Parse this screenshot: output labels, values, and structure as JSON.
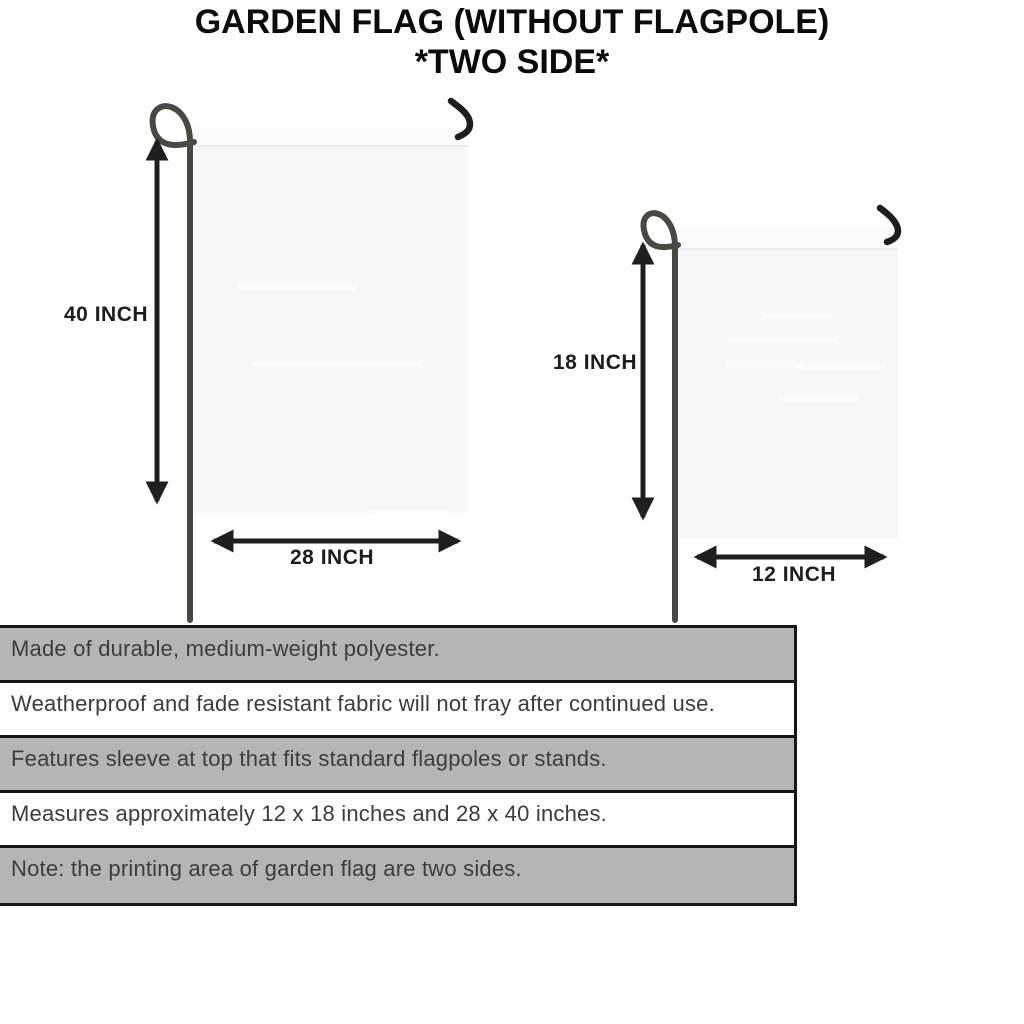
{
  "title": {
    "line1": "GARDEN FLAG (WITHOUT FLAGPOLE)",
    "line2": "*TWO SIDE*"
  },
  "diagram": {
    "large_flag": {
      "height_label": "40 INCH",
      "width_label": "28 INCH"
    },
    "small_flag": {
      "height_label": "18 INCH",
      "width_label": "12 INCH"
    }
  },
  "features": {
    "rows": [
      {
        "text": "Made of durable, medium-weight polyester.",
        "shaded": true
      },
      {
        "text": "Weatherproof and fade resistant fabric will not fray after continued use.",
        "shaded": false
      },
      {
        "text": "Features sleeve at top that fits standard flagpoles or stands.",
        "shaded": true
      },
      {
        "text": "Measures approximately 12 x 18 inches and 28 x 40 inches.",
        "shaded": false
      },
      {
        "text": "Note: the printing area of garden flag are two sides.",
        "shaded": true
      }
    ]
  },
  "colors": {
    "row_shaded": "#b5b5b5",
    "row_plain": "#ffffff",
    "table_border": "#151515",
    "flag_fill": "#f7f7f7",
    "flag_sleeve": "#fbfbfb",
    "pole": "#4a4842",
    "hook": "#1e1e1e",
    "arrow": "#1f1f1f",
    "title_text": "#0b0b0b",
    "table_text": "#3c3c3c"
  }
}
